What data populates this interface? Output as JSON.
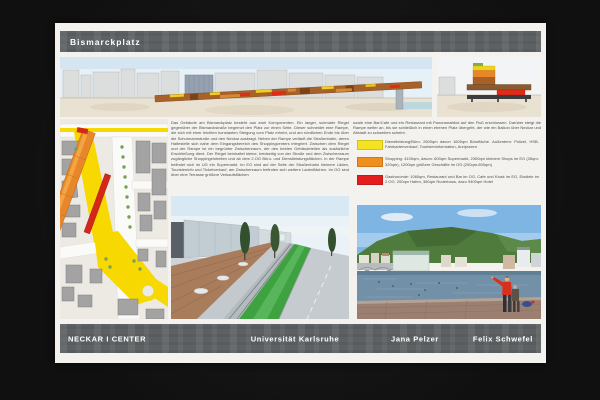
{
  "header": {
    "title": "Bismarckplatz"
  },
  "footer": {
    "project": "NECKAR I CENTER",
    "university": "Universität Karlsruhe",
    "author1": "Jana Pelzer",
    "author2": "Felix Schwefel"
  },
  "description": {
    "left": "Das Gebäude am Bismarckplatz besteht aus zwei Komponenten. Ein langer, schmaler Riegel gegenüber der Bismarckstraße begrenzt den Platz zur einen Seite. Dieser schneidet eine Rampe, die sich mit einer leichten konstanten Steigung vom Platz erhebt, und am nördlichen Ende bis über die Schurmannstraße und den Neckar auskragt. Neben der Rampe verläuft die Straßenbahn, deren Haltestelle sich nahe dem Eingangsbereich des Shoppingcenters integriert. Zwischen dem Riegel und der Rampe ist ein begrünter Zwischenraum, der den beiden Gebäudeteilen als zusätzliche Erschließung dient. Der Riegel beinhaltet kleine, beidseitig von der Straße und dem Zwischenraum zugängliche Shoppingeinheiten und ab dem 2.OG Büro- und Dienstleistungsflächen. In der Rampe befindet sich im UG ein Supermarkt. Im EG sind auf der Seite der Straßenbahn kleinere Läden, Touristeninfo und Ticketverkauf, am Zwischenraum befinden sich weitere Ladenflächen. Im OG sind über eine Terrasse größere Verkaufsflächen",
    "right": "sowie eine Bar/Cafe und ein Restaurant mit Panoramablick auf den Fluß erschlossen. Darüber steigt die Rampe weiter an, bis sie schließlich in einen ebenen Platz übergeht, der wie ein Balkon über Neckar und Altstadt zu schweben scheint."
  },
  "legend": {
    "items": [
      {
        "color": "#f5e321",
        "name": "Dienstleistung/Büro",
        "label": "Dienstleistung/Büro: 2600qm davon 1600qm Bürofläche. Außerdem: Polizei, HSB-Fahrkartenverkauf, Touristeninformation, Arztpraxen"
      },
      {
        "color": "#ef8f1f",
        "name": "Shopping",
        "label": "Shopping: 4100qm, davon: 600qm Supermarkt, 2300qm kleinere Shops im EG (35qm-320qm), 1200qm größere Geschäfte im OG (200qm-600qm)"
      },
      {
        "color": "#e41e1e",
        "name": "Gastronomie",
        "label": "Gastronomie: 1060qm, Restaurant und Bar im OG, Cafe und Kiosk im EG, Eisdiele im 2.OG. 200qm Hafen, 380qm Ruderhaus, dazu 9400qm Hotel"
      }
    ]
  },
  "colors": {
    "bar_gray": "#5d6163",
    "poster_white": "#f4f2ee",
    "accent_yellow": "#f5e321",
    "accent_orange": "#ef8f1f",
    "accent_red": "#e41e1e"
  }
}
